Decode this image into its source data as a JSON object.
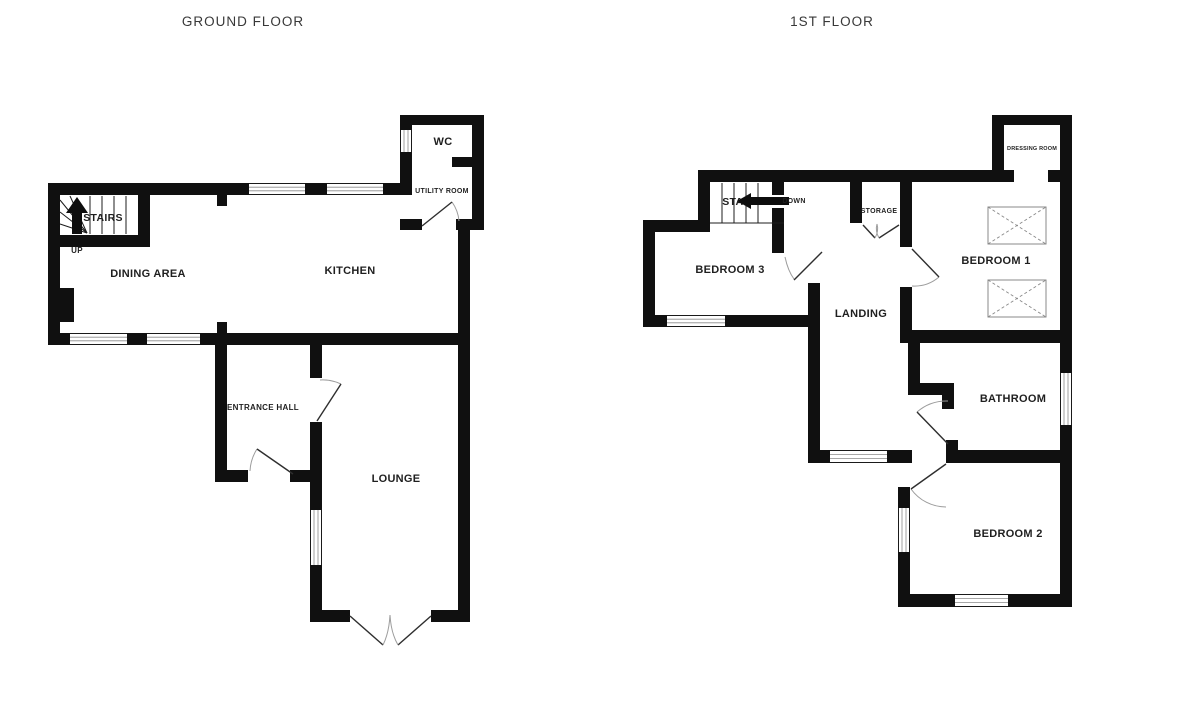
{
  "document": {
    "type": "two-storey-house-floorplan"
  },
  "colors": {
    "background": "#ffffff",
    "wall": "#101010",
    "label_text": "#1f1f1f",
    "title_text": "#383838",
    "window_line": "#8a8a8a",
    "door_arc": "#9c9c9c",
    "bed_symbol": "#8a8a8a"
  },
  "icons": {
    "stairs_up_arrow": "arrow-up",
    "stairs_down_arrow": "arrow-left"
  },
  "ground_floor": {
    "title": "GROUND FLOOR",
    "labels": {
      "stairs": "STAIRS",
      "up": "UP",
      "dining": "DINING AREA",
      "kitchen": "KITCHEN",
      "wc": "WC",
      "utility": "UTILITY ROOM",
      "entrance": "ENTRANCE HALL",
      "lounge": "LOUNGE"
    }
  },
  "first_floor": {
    "title": "1ST FLOOR",
    "labels": {
      "stairs": "STAIRS",
      "down": "DOWN",
      "storage": "STORAGE",
      "dressing": "DRESSING ROOM",
      "bedroom1": "BEDROOM 1",
      "bedroom3": "BEDROOM 3",
      "landing": "LANDING",
      "bathroom": "BATHROOM",
      "bedroom2": "BEDROOM 2"
    }
  }
}
